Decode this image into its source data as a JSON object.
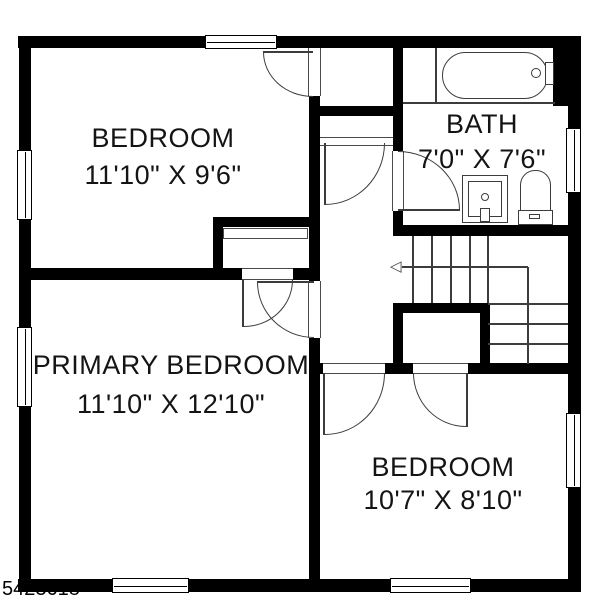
{
  "plan": {
    "type": "residential-floor-plan",
    "rooms": [
      {
        "label": "BEDROOM",
        "dims": "11'10\" X 9'6\""
      },
      {
        "label": "BATH",
        "dims": "7'0\" X 7'6\""
      },
      {
        "label": "PRIMARY BEDROOM",
        "dims": "11'10\" X 12'10\""
      },
      {
        "label": "BEDROOM",
        "dims": "10'7\" X 8'10\""
      }
    ],
    "listing_number": "5423618",
    "fixtures": [
      "bathtub",
      "sink-vanity",
      "toilet",
      "staircase",
      "closets"
    ],
    "icons": {
      "stair_arrow": "◁"
    },
    "colors": {
      "wall": "#000000",
      "line": "#3c3c3c",
      "background": "#ffffff"
    }
  }
}
